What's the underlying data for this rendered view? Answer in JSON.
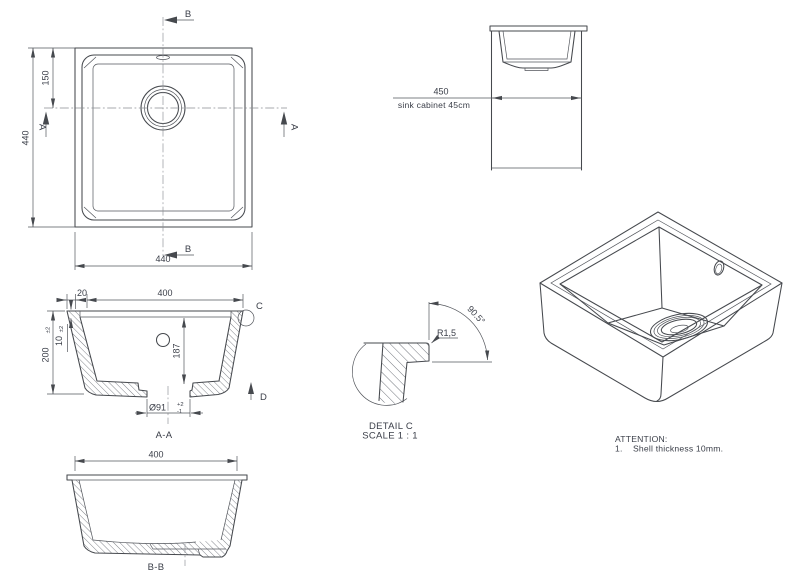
{
  "colors": {
    "background": "#ffffff",
    "line": "#46494e",
    "dim_line": "#53565c",
    "text": "#3a3e48",
    "centerline": "#8b8e94"
  },
  "plan_view": {
    "dim_height": "440",
    "dim_drain_from_top": "150",
    "dim_width": "440",
    "section_b_top": "B",
    "section_b_bottom": "B",
    "section_a_left": "A",
    "section_a_right": "A"
  },
  "cabinet_view": {
    "dim_width": "450",
    "label": "sink cabinet 45cm"
  },
  "section_aa": {
    "title": "A-A",
    "dim_rim": "20",
    "dim_opening": "400",
    "dim_height": "200",
    "dim_height_tol": "±2",
    "dim_shell": "10",
    "dim_shell_tol": "±2",
    "dim_depth": "187",
    "dim_drain": "Ø91",
    "dim_drain_tol_upper": "+2",
    "dim_drain_tol_lower": "-1",
    "detail_label": "C",
    "direction_label": "D"
  },
  "section_bb": {
    "title": "B-B",
    "dim_opening": "400"
  },
  "detail_c": {
    "title": "DETAIL C",
    "scale": "SCALE 1 : 1",
    "angle": "90.5°",
    "radius": "R1,5"
  },
  "notes": {
    "attention": "ATTENTION:",
    "item_number": "1.",
    "item_text": "Shell thickness 10mm."
  }
}
